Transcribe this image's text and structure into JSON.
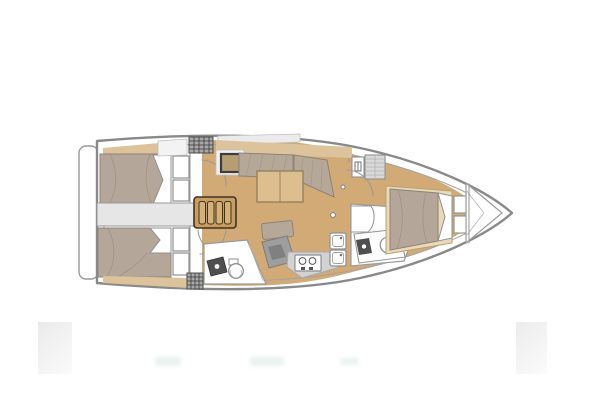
{
  "image": {
    "kind": "sailing-yacht-interior-floor-plan",
    "orientation": "bow-right",
    "background": "#ffffff"
  },
  "features": [
    {
      "id": "swim-platform",
      "desc": "stern swim platform"
    },
    {
      "id": "aft-cabin-port",
      "desc": "aft double-berth cabin (top) with pillows and lockers"
    },
    {
      "id": "aft-cabin-starboard",
      "desc": "aft double-berth cabin (bottom) with pillows and lockers"
    },
    {
      "id": "cockpit-companionway",
      "desc": "companionway passage from cockpit"
    },
    {
      "id": "companionway-steps",
      "desc": "wooden companionway steps"
    },
    {
      "id": "aft-head",
      "desc": "aft head with basin and toilet"
    },
    {
      "id": "salon",
      "desc": "salon with L-settee, table, bench and chart module"
    },
    {
      "id": "galley",
      "desc": "galley with two-burner stove and twin sinks"
    },
    {
      "id": "forward-head",
      "desc": "forward head with shower partition, vanity, basin and toilet"
    },
    {
      "id": "forward-cabin",
      "desc": "forward double berth with shelves, closet and vent locker"
    },
    {
      "id": "anchor-locker",
      "desc": "bow anchor locker"
    }
  ],
  "colors": {
    "hull_outline": "#898989",
    "hull_inner": "#a3a3a3",
    "white": "#ffffff",
    "floor_wood": "#d2aa76",
    "shelf_wood": "#dcc39b",
    "mattress": "#b4a79a",
    "pillow": "#ffffff",
    "cushion": "#b6a898",
    "table_wood": "#ddbe8e",
    "table_edge": "#97815c",
    "steps_wood": "#c89e5f",
    "steps_slat": "#d6b176",
    "steps_dark": "#3f3222",
    "counter_gray": "#d2d2d2",
    "module_gray": "#9e9e9e",
    "module_dark": "#808080",
    "companionway_gray": "#e6e6e6",
    "hatch_gray": "#d9d9d9",
    "grid_fill": "#a8a8a8",
    "fixture_dark": "#4f4f4f",
    "panel_white": "#f3f3f3",
    "bed_base": "#ead9b6"
  }
}
